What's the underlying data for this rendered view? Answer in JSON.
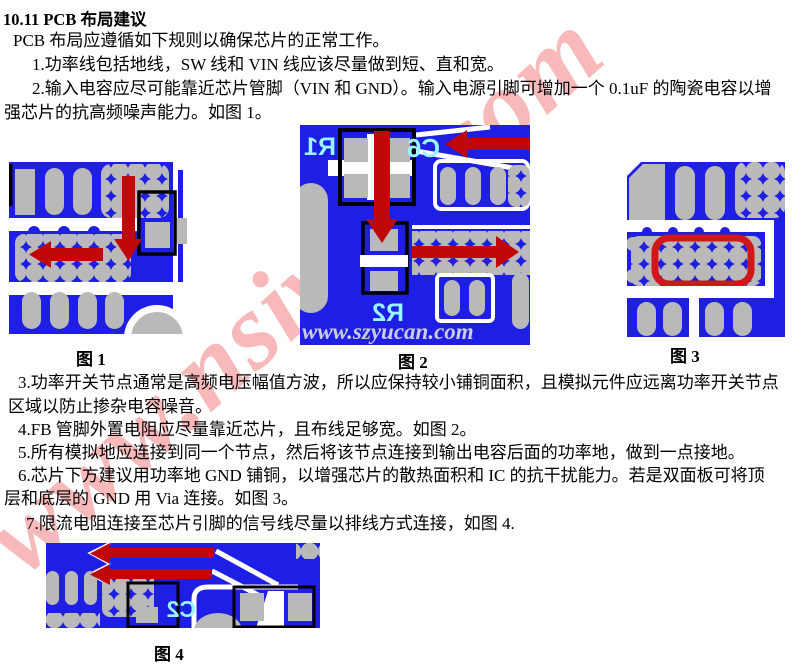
{
  "title": "10.11 PCB 布局建议",
  "body": {
    "intro": "PCB 布局应遵循如下规则以确保芯片的正常工作。",
    "item1": "1.功率线包括地线，SW 线和 VIN 线应该尽量做到短、直和宽。",
    "item2a": "2.输入电容应尽可能靠近芯片管脚（VIN 和 GND）。输入电源引脚可增加一个 0.1uF 的陶瓷电容以增",
    "item2b": "强芯片的抗高频噪声能力。如图 1。",
    "item3a": "3.功率开关节点通常是高频电压幅值方波，所以应保持较小铺铜面积，且模拟元件应远离功率开关节点",
    "item3b": "区域以防止掺杂电容噪音。",
    "item4": "4.FB 管脚外置电阻应尽量靠近芯片，且布线足够宽。如图 2。",
    "item5": "5.所有模拟地应连接到同一个节点，然后将该节点连接到输出电容后面的功率地，做到一点接地。",
    "item6a": "6.芯片下方建议用功率地 GND 铺铜，以增强芯片的散热面积和 IC 的抗干扰能力。若是双面板可将顶",
    "item6b": "层和底层的 GND 用 Via 连接。如图 3。",
    "item7": "7.限流电阻连接至芯片引脚的信号线尽量以排线方式连接，如图 4."
  },
  "figures": {
    "fig1_label": "图 1",
    "fig2_label": "图 2",
    "fig3_label": "图 3",
    "fig4_label": "图 4"
  },
  "designators": {
    "r1": "R1",
    "c6": "C6",
    "r2": "R2",
    "c2": "C2"
  },
  "watermarks": {
    "page": "www.nsiway.com",
    "figure2": "www.szyucan.com"
  },
  "colors": {
    "pcb_blue": "#1E1EE4",
    "pad_gray": "#B9B9B9",
    "arrow_red": "#C00808",
    "highlight_red": "#D01818",
    "silkscreen_cyan": "#99F5FF",
    "page_watermark_pink": "#F28084",
    "figure_watermark_gray": "#C9CDDD"
  }
}
